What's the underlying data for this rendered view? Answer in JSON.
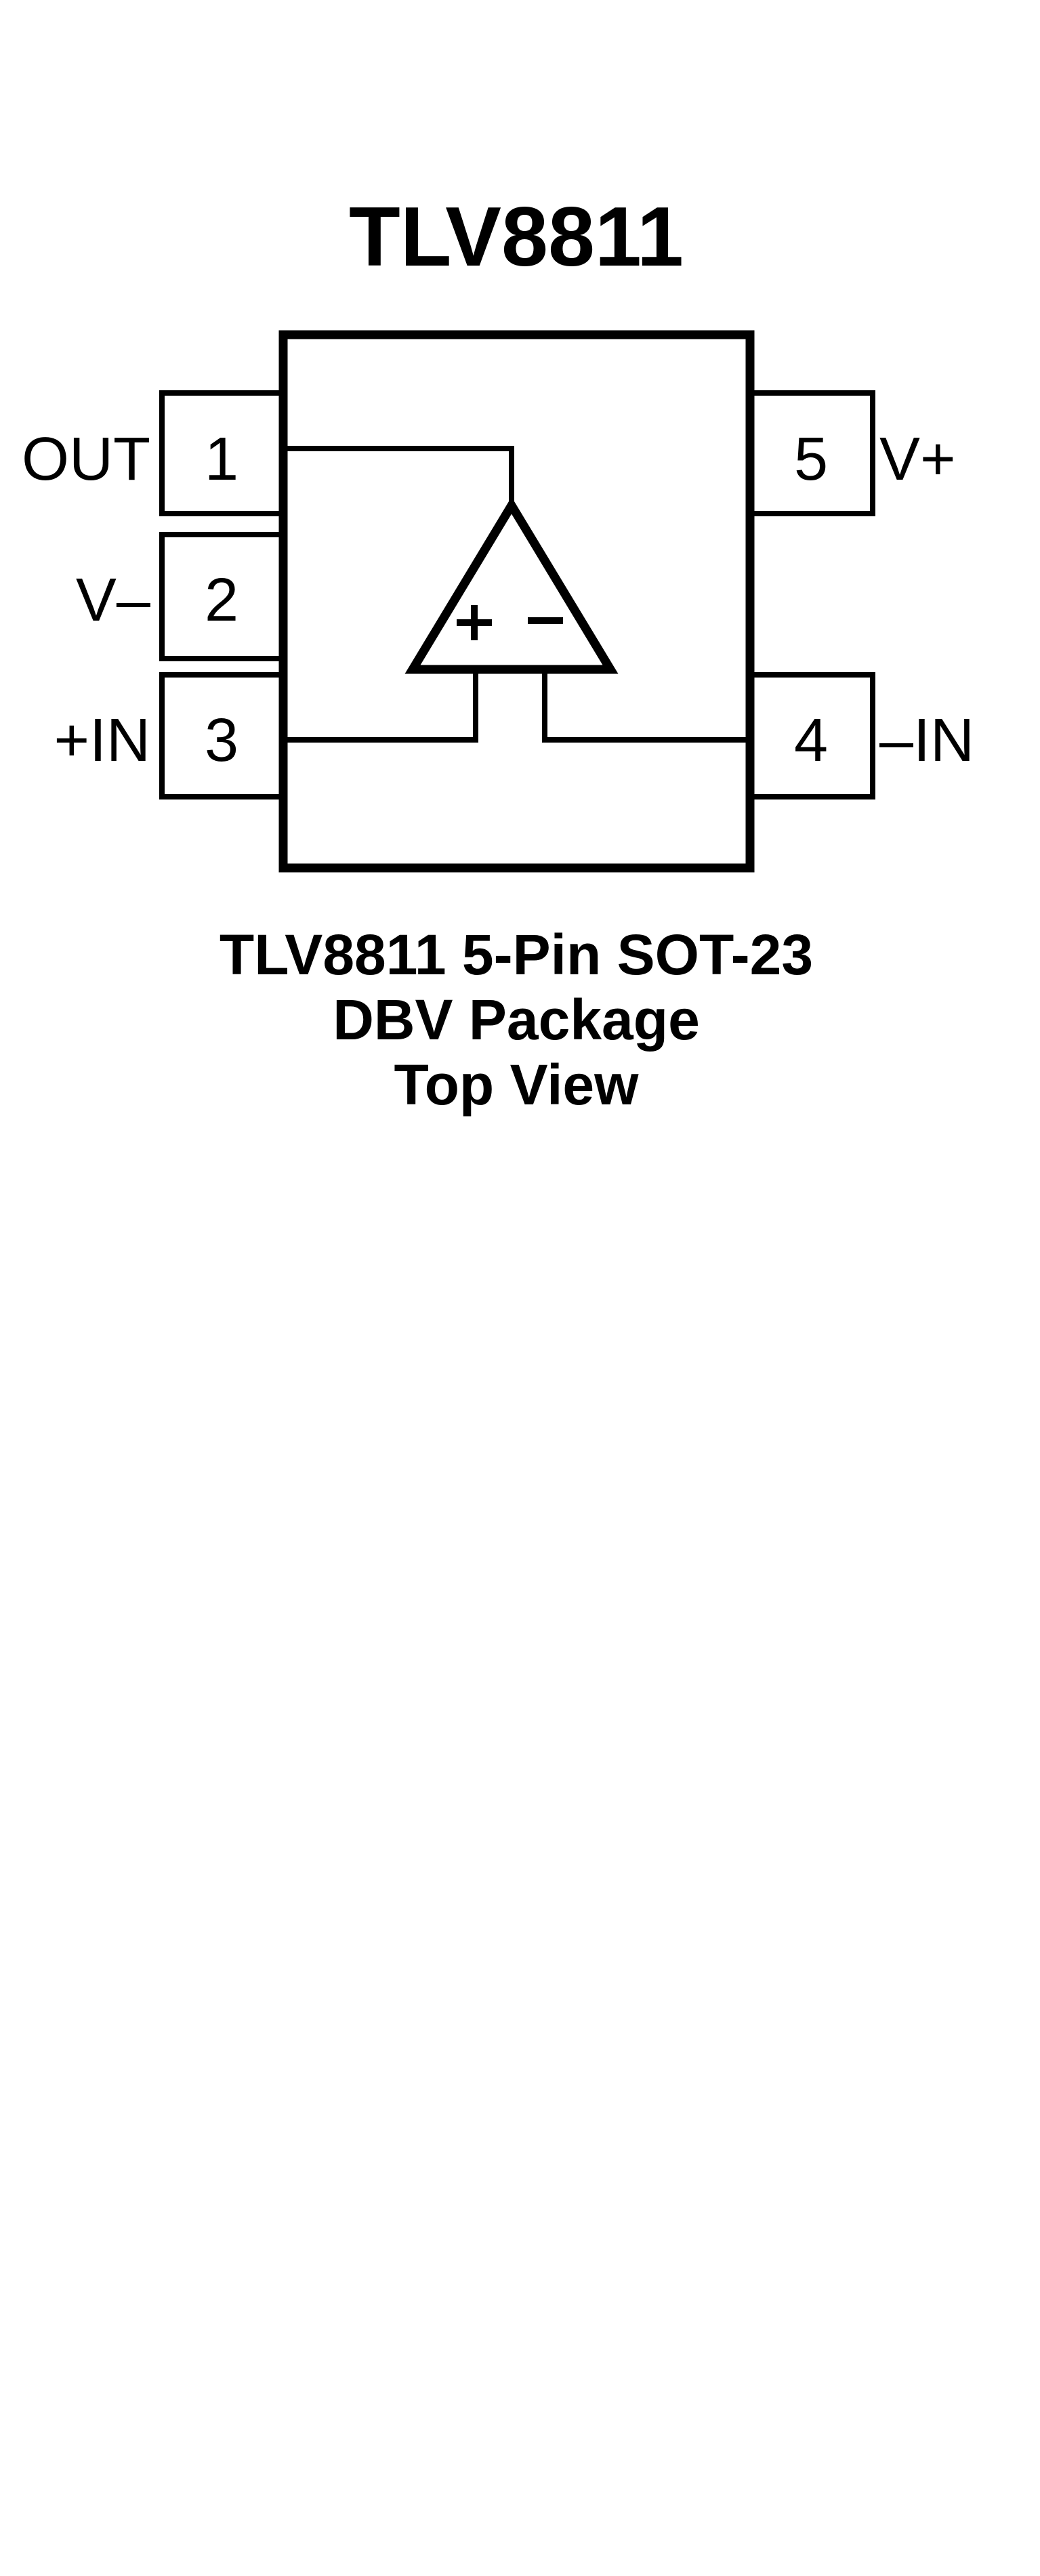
{
  "title": "TLV8811",
  "package": {
    "pins": [
      {
        "number": "1",
        "label": "OUT",
        "side": "left",
        "row": "top"
      },
      {
        "number": "2",
        "label": "V–",
        "side": "left",
        "row": "middle"
      },
      {
        "number": "3",
        "label": "+IN",
        "side": "left",
        "row": "bottom"
      },
      {
        "number": "4",
        "label": "–IN",
        "side": "right",
        "row": "bottom"
      },
      {
        "number": "5",
        "label": "V+",
        "side": "right",
        "row": "top"
      }
    ],
    "opamp": {
      "symbol": "triangle",
      "plus_input": "+",
      "minus_input": "−"
    }
  },
  "caption": {
    "line1": "TLV8811 5-Pin SOT-23",
    "line2": "DBV Package",
    "line3": "Top View"
  },
  "colors": {
    "ink": "#000000",
    "background": "#ffffff"
  }
}
